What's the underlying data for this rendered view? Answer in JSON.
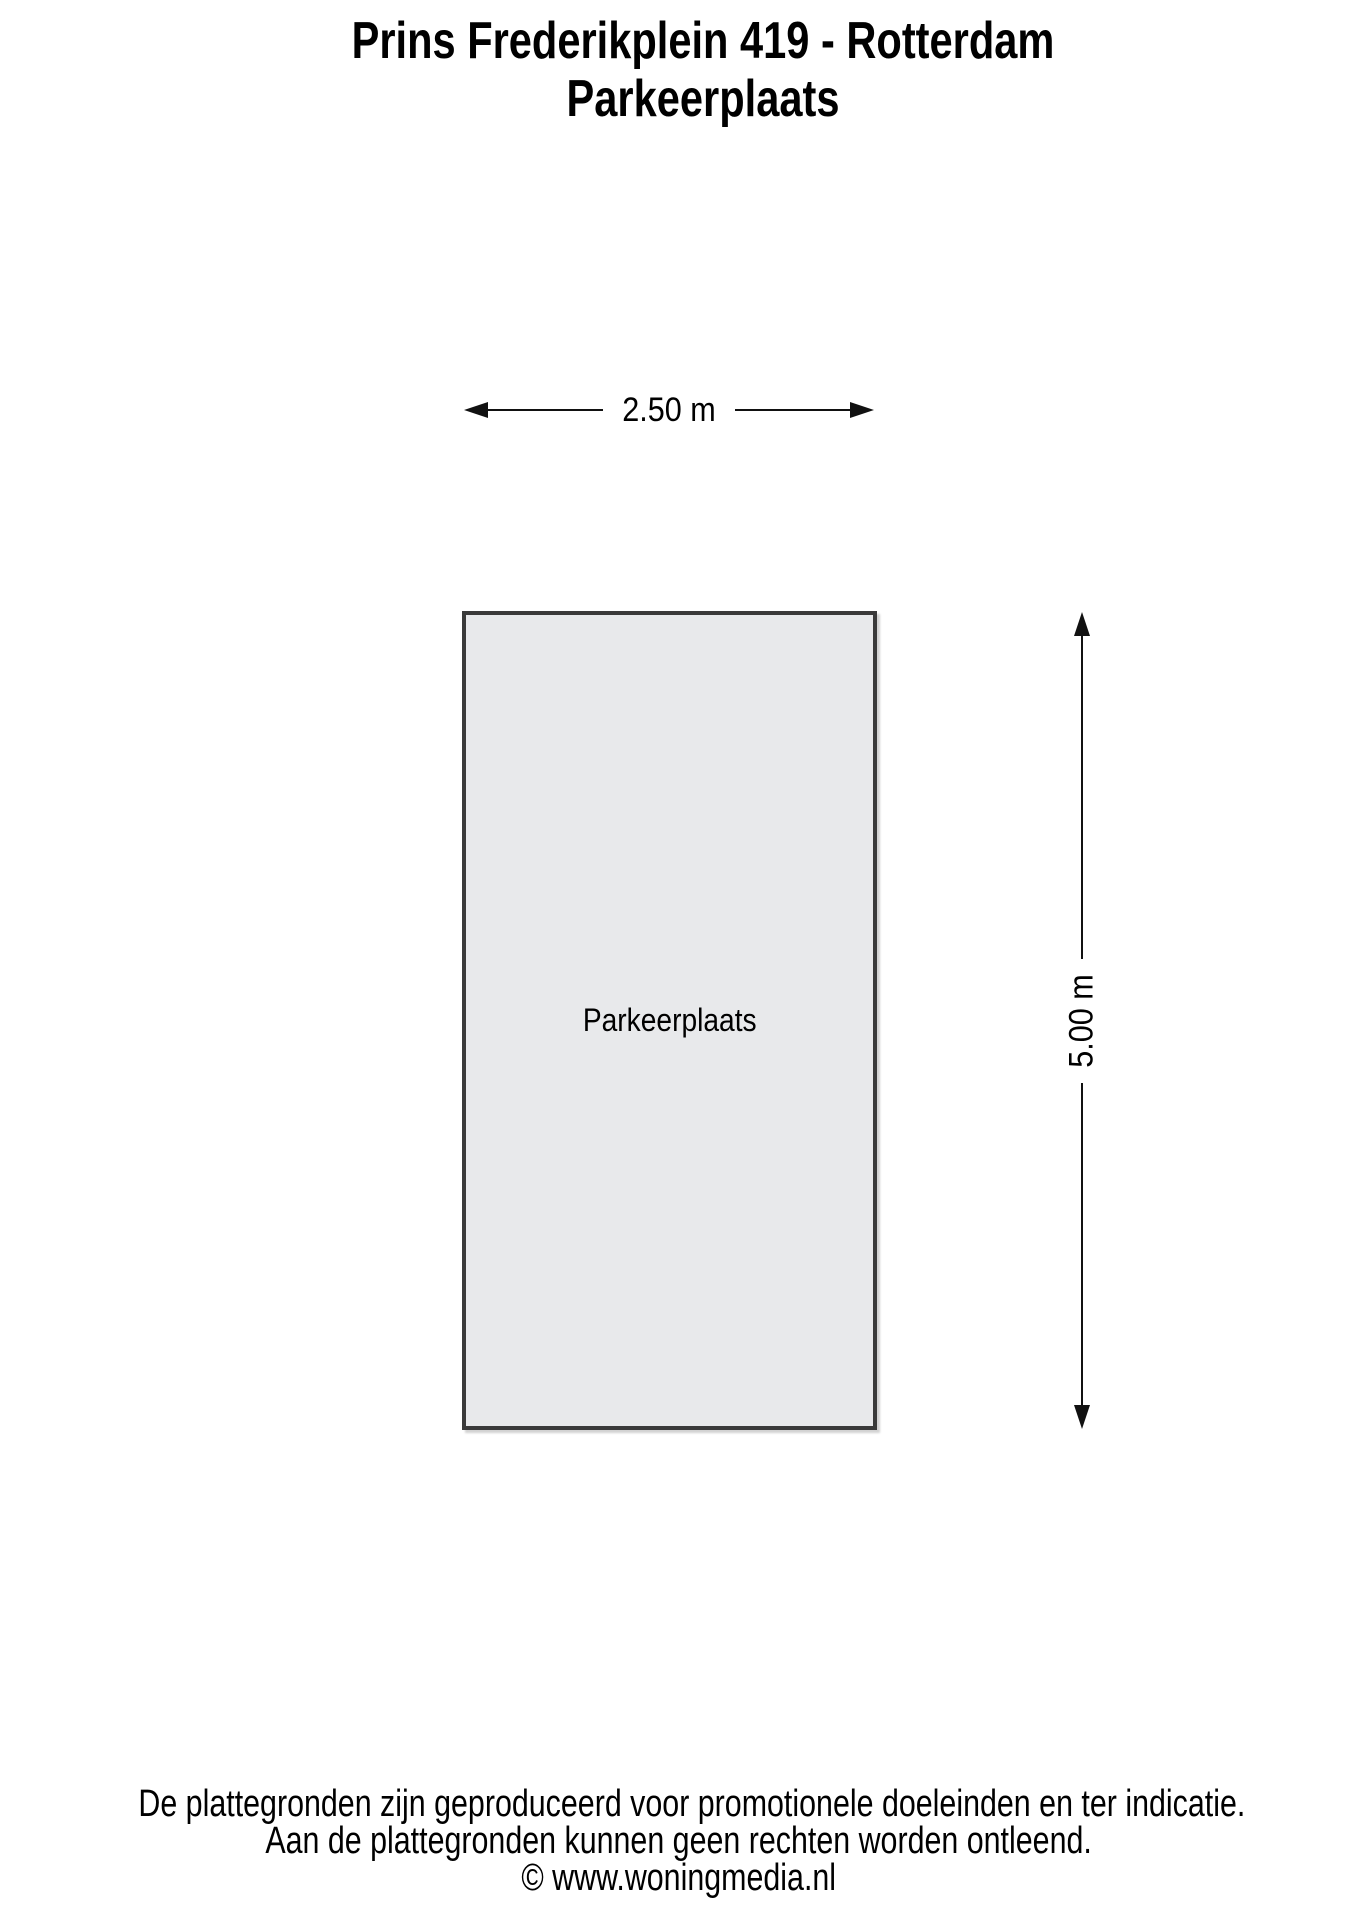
{
  "title": {
    "line1": "Prins Frederikplein 419 - Rotterdam",
    "line2": "Parkeerplaats"
  },
  "plan": {
    "room_label": "Parkeerplaats",
    "width_dimension_label": "2.50 m",
    "height_dimension_label": "5.00 m",
    "room_fill_color": "#e8e9eb",
    "room_border_color": "#3a3a3a",
    "line_color": "#111111"
  },
  "footer": {
    "line1": "De plattegronden zijn geproduceerd voor promotionele doeleinden en ter indicatie.",
    "line2": "Aan de plattegronden kunnen geen rechten worden ontleend.",
    "line3": "© www.woningmedia.nl"
  }
}
